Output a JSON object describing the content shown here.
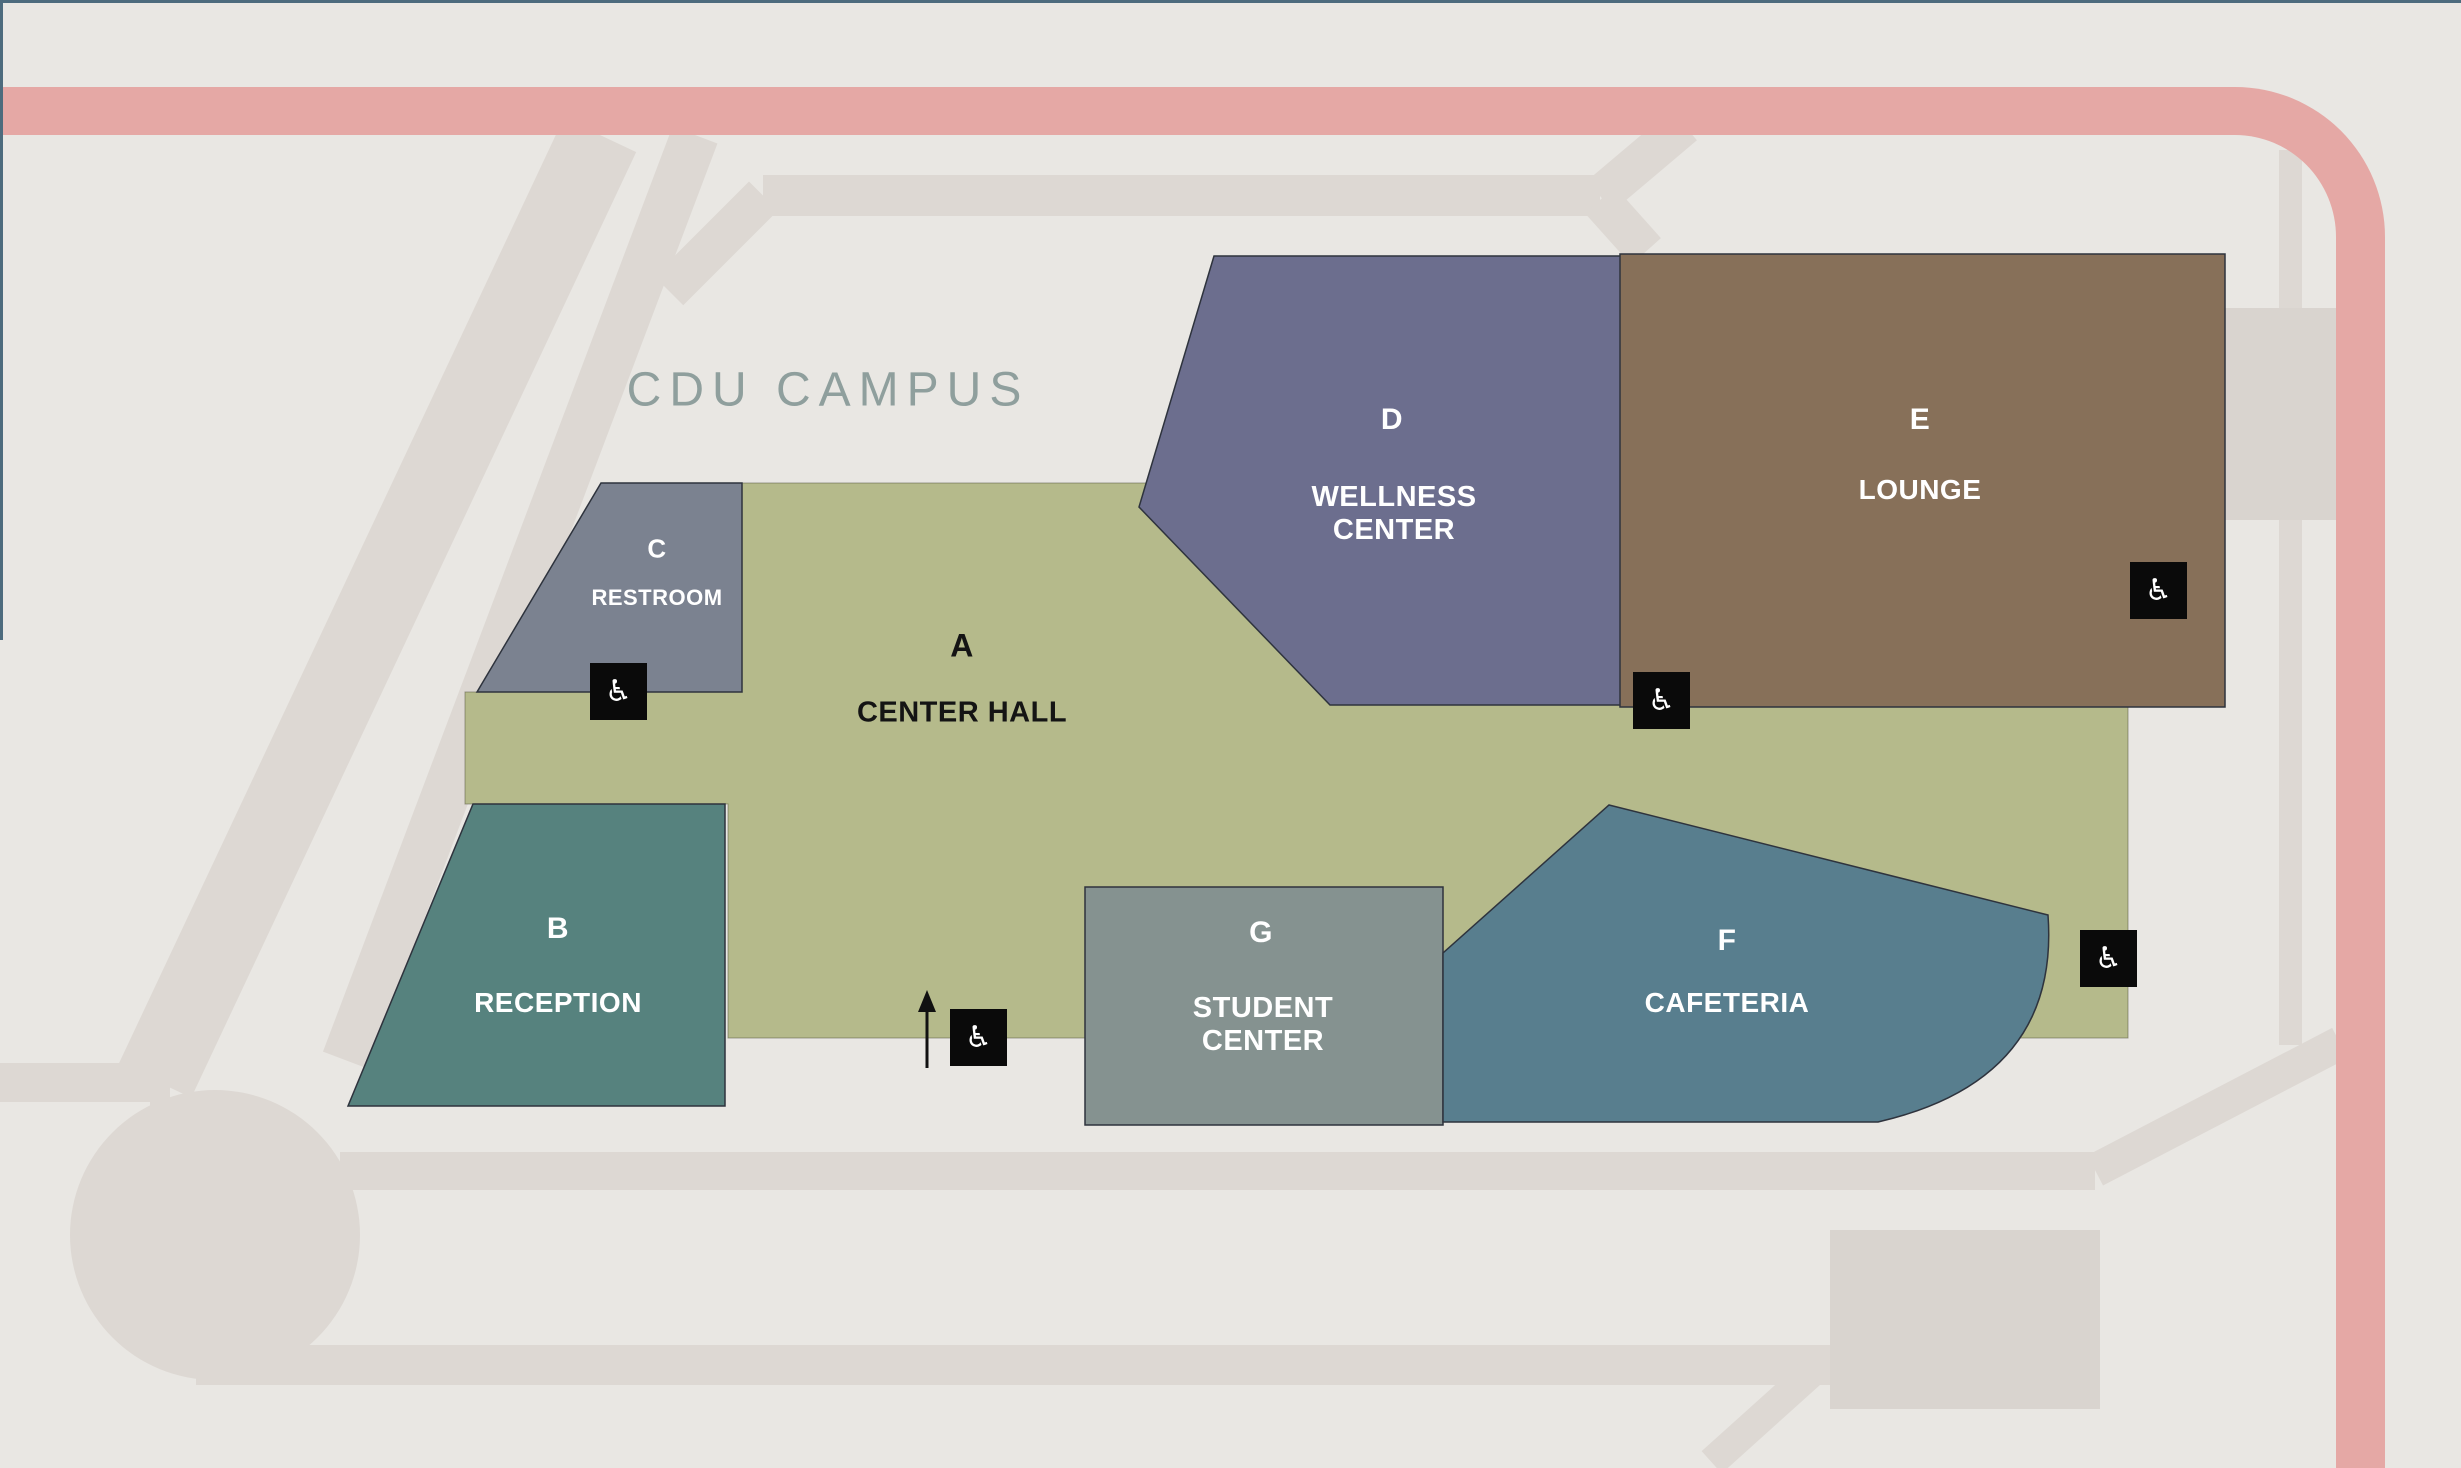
{
  "map": {
    "title": "CDU CAMPUS"
  },
  "buildings": {
    "a": {
      "letter": "A",
      "name": "CENTER HALL",
      "color": "#b5ba8b",
      "text_color": "#141414"
    },
    "b": {
      "letter": "B",
      "name": "RECEPTION",
      "color": "#56827e",
      "text_color": "#ffffff"
    },
    "c": {
      "letter": "C",
      "name": "RESTROOM",
      "color": "#7b8290",
      "text_color": "#ffffff"
    },
    "d": {
      "letter": "D",
      "name": "WELLNESS\nCENTER",
      "color": "#6c6e8e",
      "text_color": "#ffffff"
    },
    "e": {
      "letter": "E",
      "name": "LOUNGE",
      "color": "#877059",
      "text_color": "#ffffff"
    },
    "f": {
      "letter": "F",
      "name": "CAFETERIA",
      "color": "#587e8e",
      "text_color": "#ffffff"
    },
    "g": {
      "letter": "G",
      "name": "STUDENT\nCENTER",
      "color": "#859290",
      "text_color": "#ffffff"
    }
  },
  "icons": {
    "accessibility_glyph": "♿",
    "accessibility_meaning": "wheelchair accessible entrance marker",
    "entrance_arrow_meaning": "main entrance direction arrow"
  },
  "colors": {
    "background": "#e9e7e3",
    "road": "#ddd8d3",
    "parking": "#d9d4cf",
    "highway_pink": "#e5a8a5",
    "map_frame": "#4d6b7d",
    "hall_green": "#b5ba8b",
    "title_text": "#8f9f9d",
    "marker_black": "#0a0a0a"
  }
}
